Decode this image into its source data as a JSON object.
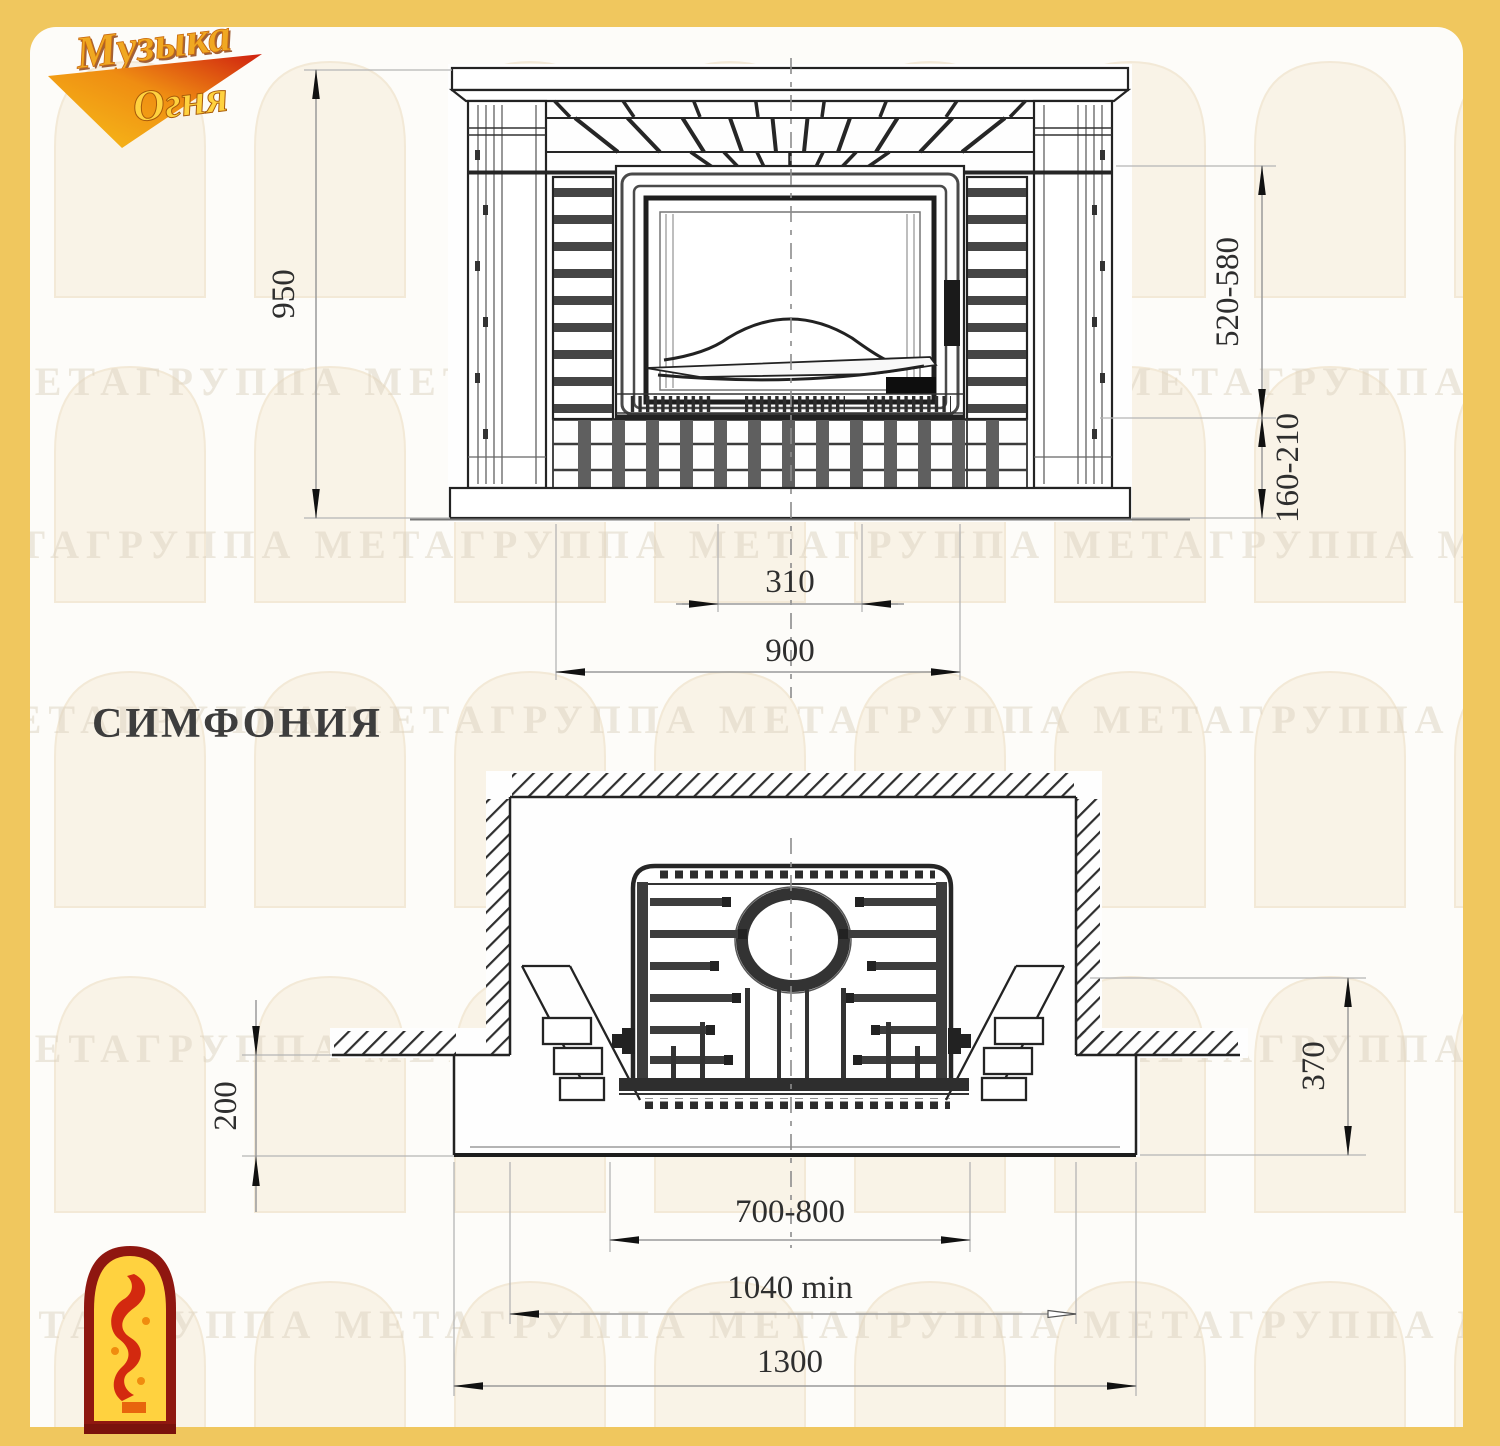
{
  "logo": {
    "line1": "Музыка",
    "line2": "Огня"
  },
  "model": {
    "name": "СИМФОНИЯ"
  },
  "front_view": {
    "dims": {
      "overall_height": "950",
      "opening_height": "520-580",
      "hearth_height": "160-210",
      "grate_width": "310",
      "firebox_width": "900"
    }
  },
  "plan_view": {
    "dims": {
      "hearth_projection": "200",
      "side_depth": "370",
      "insert_width": "700-800",
      "niche_width_min": "1040 min",
      "overall_width": "1300"
    }
  },
  "watermark": {
    "row_text": "МЕТАГРУППА МЕТАГРУППА МЕТАГРУППА МЕТАГРУППА МЕТА"
  },
  "colors": {
    "border_gold": "#F0C75E",
    "accent_red": "#D42A10",
    "accent_yellow": "#FFD23F"
  }
}
